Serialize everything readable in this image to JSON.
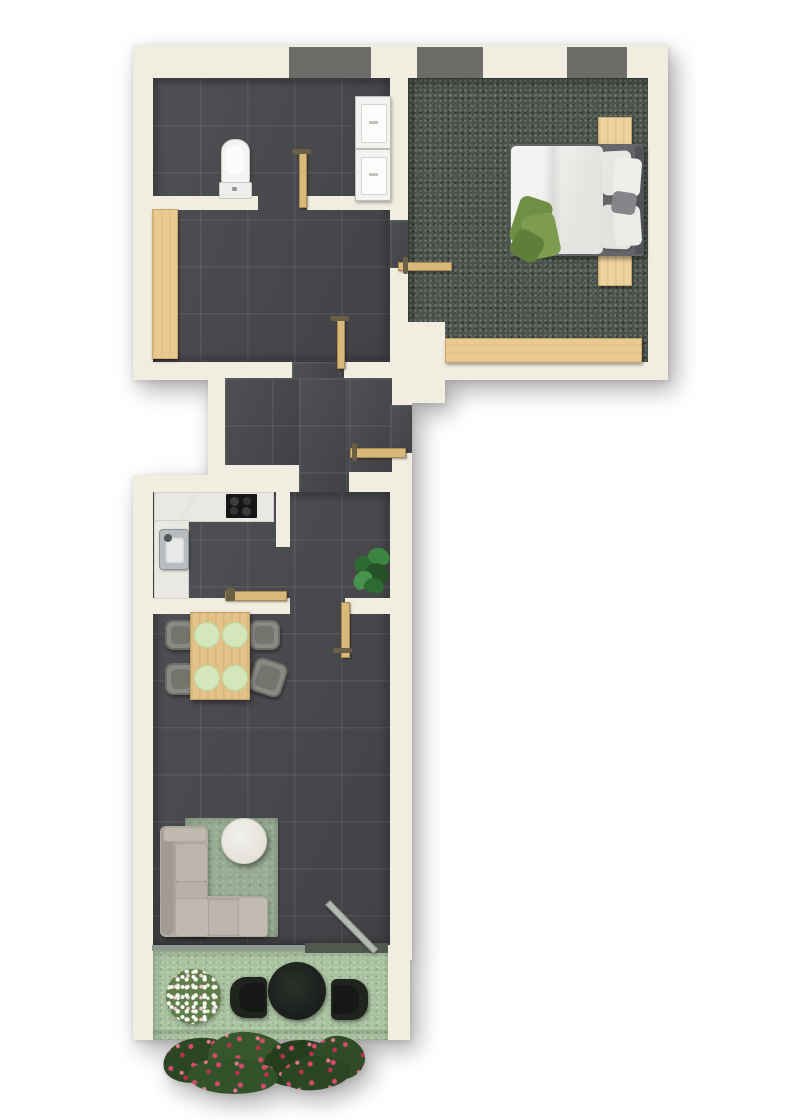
{
  "app": {
    "type": "floor-plan-rendering",
    "title": "Apartment floor plan, top-down 3D render",
    "canvas": {
      "width": 800,
      "height": 1120
    }
  },
  "palette": {
    "background": "#ffffff",
    "wall_cream": "#f1ede1",
    "tile_floor": "#46474b",
    "bedroom_carpet": "#4b544c",
    "terrace_turf": "#a9c2a0",
    "living_rug": "#99ac94",
    "light_wood": "#e9cb92",
    "door_wood": "#d9b87c",
    "window_grey": "#6e6c69",
    "counter_marble": "#eae8e2",
    "sofa_beige": "#b3aca2",
    "chair_grey": "#8a8983",
    "plate_green": "#d3e7ba",
    "plant_green": "#3a7c3e",
    "hedge_green": "#2d4a24",
    "flower_red": "#cf3a60",
    "flower_white": "#f5f7f0",
    "outdoor_black": "#20241f",
    "glass": "#8d9991"
  },
  "rooms": {
    "bathroom": {
      "label": "Bathroom",
      "features": [
        "toilet",
        "stacked washer and dryer",
        "door"
      ]
    },
    "hallway": {
      "label": "Hallway",
      "features": [
        "built-in wardrobe",
        "door to bathroom",
        "door to bedroom",
        "door to corridor"
      ]
    },
    "bedroom": {
      "label": "Bedroom",
      "features": [
        "double bed",
        "two nightstands",
        "low wardrobe bench",
        "dark green carpet",
        "two windows"
      ]
    },
    "corridor": {
      "label": "Entry corridor",
      "features": [
        "entry door"
      ]
    },
    "kitchen": {
      "label": "Kitchen",
      "features": [
        "L-shaped counter",
        "cooktop",
        "sink"
      ]
    },
    "dining": {
      "label": "Dining area",
      "features": [
        "wooden table",
        "four chairs",
        "four place settings",
        "potted plant"
      ]
    },
    "living": {
      "label": "Living room",
      "features": [
        "corner sofa",
        "round coffee table",
        "area rug",
        "sliding glass door"
      ]
    },
    "terrace": {
      "label": "Terrace",
      "features": [
        "lawn",
        "round outdoor table",
        "two outdoor chairs",
        "white flowering bush",
        "red flower hedge"
      ]
    }
  },
  "counts": {
    "windows": 3,
    "door_leaves": 6,
    "dining_chairs": 4,
    "place_settings": 4,
    "terrace_chairs": 2,
    "nightstands": 2
  }
}
